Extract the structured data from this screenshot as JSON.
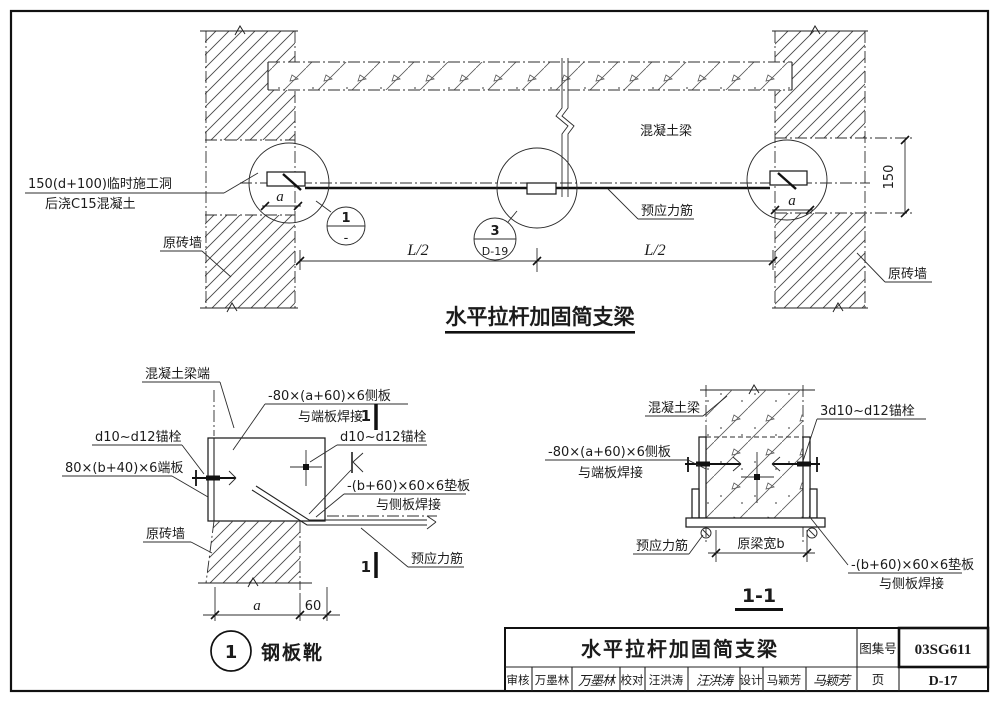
{
  "main": {
    "title": "水平拉杆加固简支梁",
    "labels": {
      "temp_opening_1": "150(d+100)临时施工洞",
      "temp_opening_2": "后浇C15混凝土",
      "left_wall": "原砖墙",
      "right_wall": "原砖墙",
      "beam": "混凝土梁",
      "tendon": "预应力筋"
    },
    "dims": {
      "a_left": "a",
      "a_right": "a",
      "h150": "150",
      "l2_left": "L/2",
      "l2_right": "L/2"
    },
    "refs": {
      "shoe_num": "1",
      "shoe_page": "-",
      "turnbuckle_num": "3",
      "turnbuckle_page": "D-19"
    }
  },
  "detail1": {
    "number": "1",
    "title": "钢板靴",
    "section_mark": "1",
    "labels": {
      "beam_end": "混凝土梁端",
      "side_plate_1": "-80×(a+60)×6侧板",
      "side_plate_2": "与端板焊接",
      "anchor_left": "d10~d12锚栓",
      "anchor_right": "d10~d12锚栓",
      "end_plate": "80×(b+40)×6端板",
      "pad_plate_1": "-(b+60)×60×6垫板",
      "pad_plate_2": "与侧板焊接",
      "wall": "原砖墙",
      "tendon": "预应力筋"
    },
    "dims": {
      "a": "a",
      "d60": "60"
    }
  },
  "section11": {
    "title": "1-1",
    "labels": {
      "beam": "混凝土梁",
      "anchors": "3d10~d12锚栓",
      "side_plate_1": "-80×(a+60)×6侧板",
      "side_plate_2": "与端板焊接",
      "tendon": "预应力筋",
      "beam_width": "原梁宽b",
      "pad_plate_1": "-(b+60)×60×6垫板",
      "pad_plate_2": "与侧板焊接"
    }
  },
  "titleblock": {
    "title": "水平拉杆加固简支梁",
    "atlas_label": "图集号",
    "atlas_no": "03SG611",
    "page_label": "页",
    "page_no": "D-17",
    "review_label": "审核",
    "reviewer": "万墨林",
    "reviewer_sig": "万墨林",
    "check_label": "校对",
    "checker": "汪洪涛",
    "checker_sig": "汪洪涛",
    "design_label": "设计",
    "designer": "马颖芳",
    "designer_sig": "马颖芳"
  }
}
